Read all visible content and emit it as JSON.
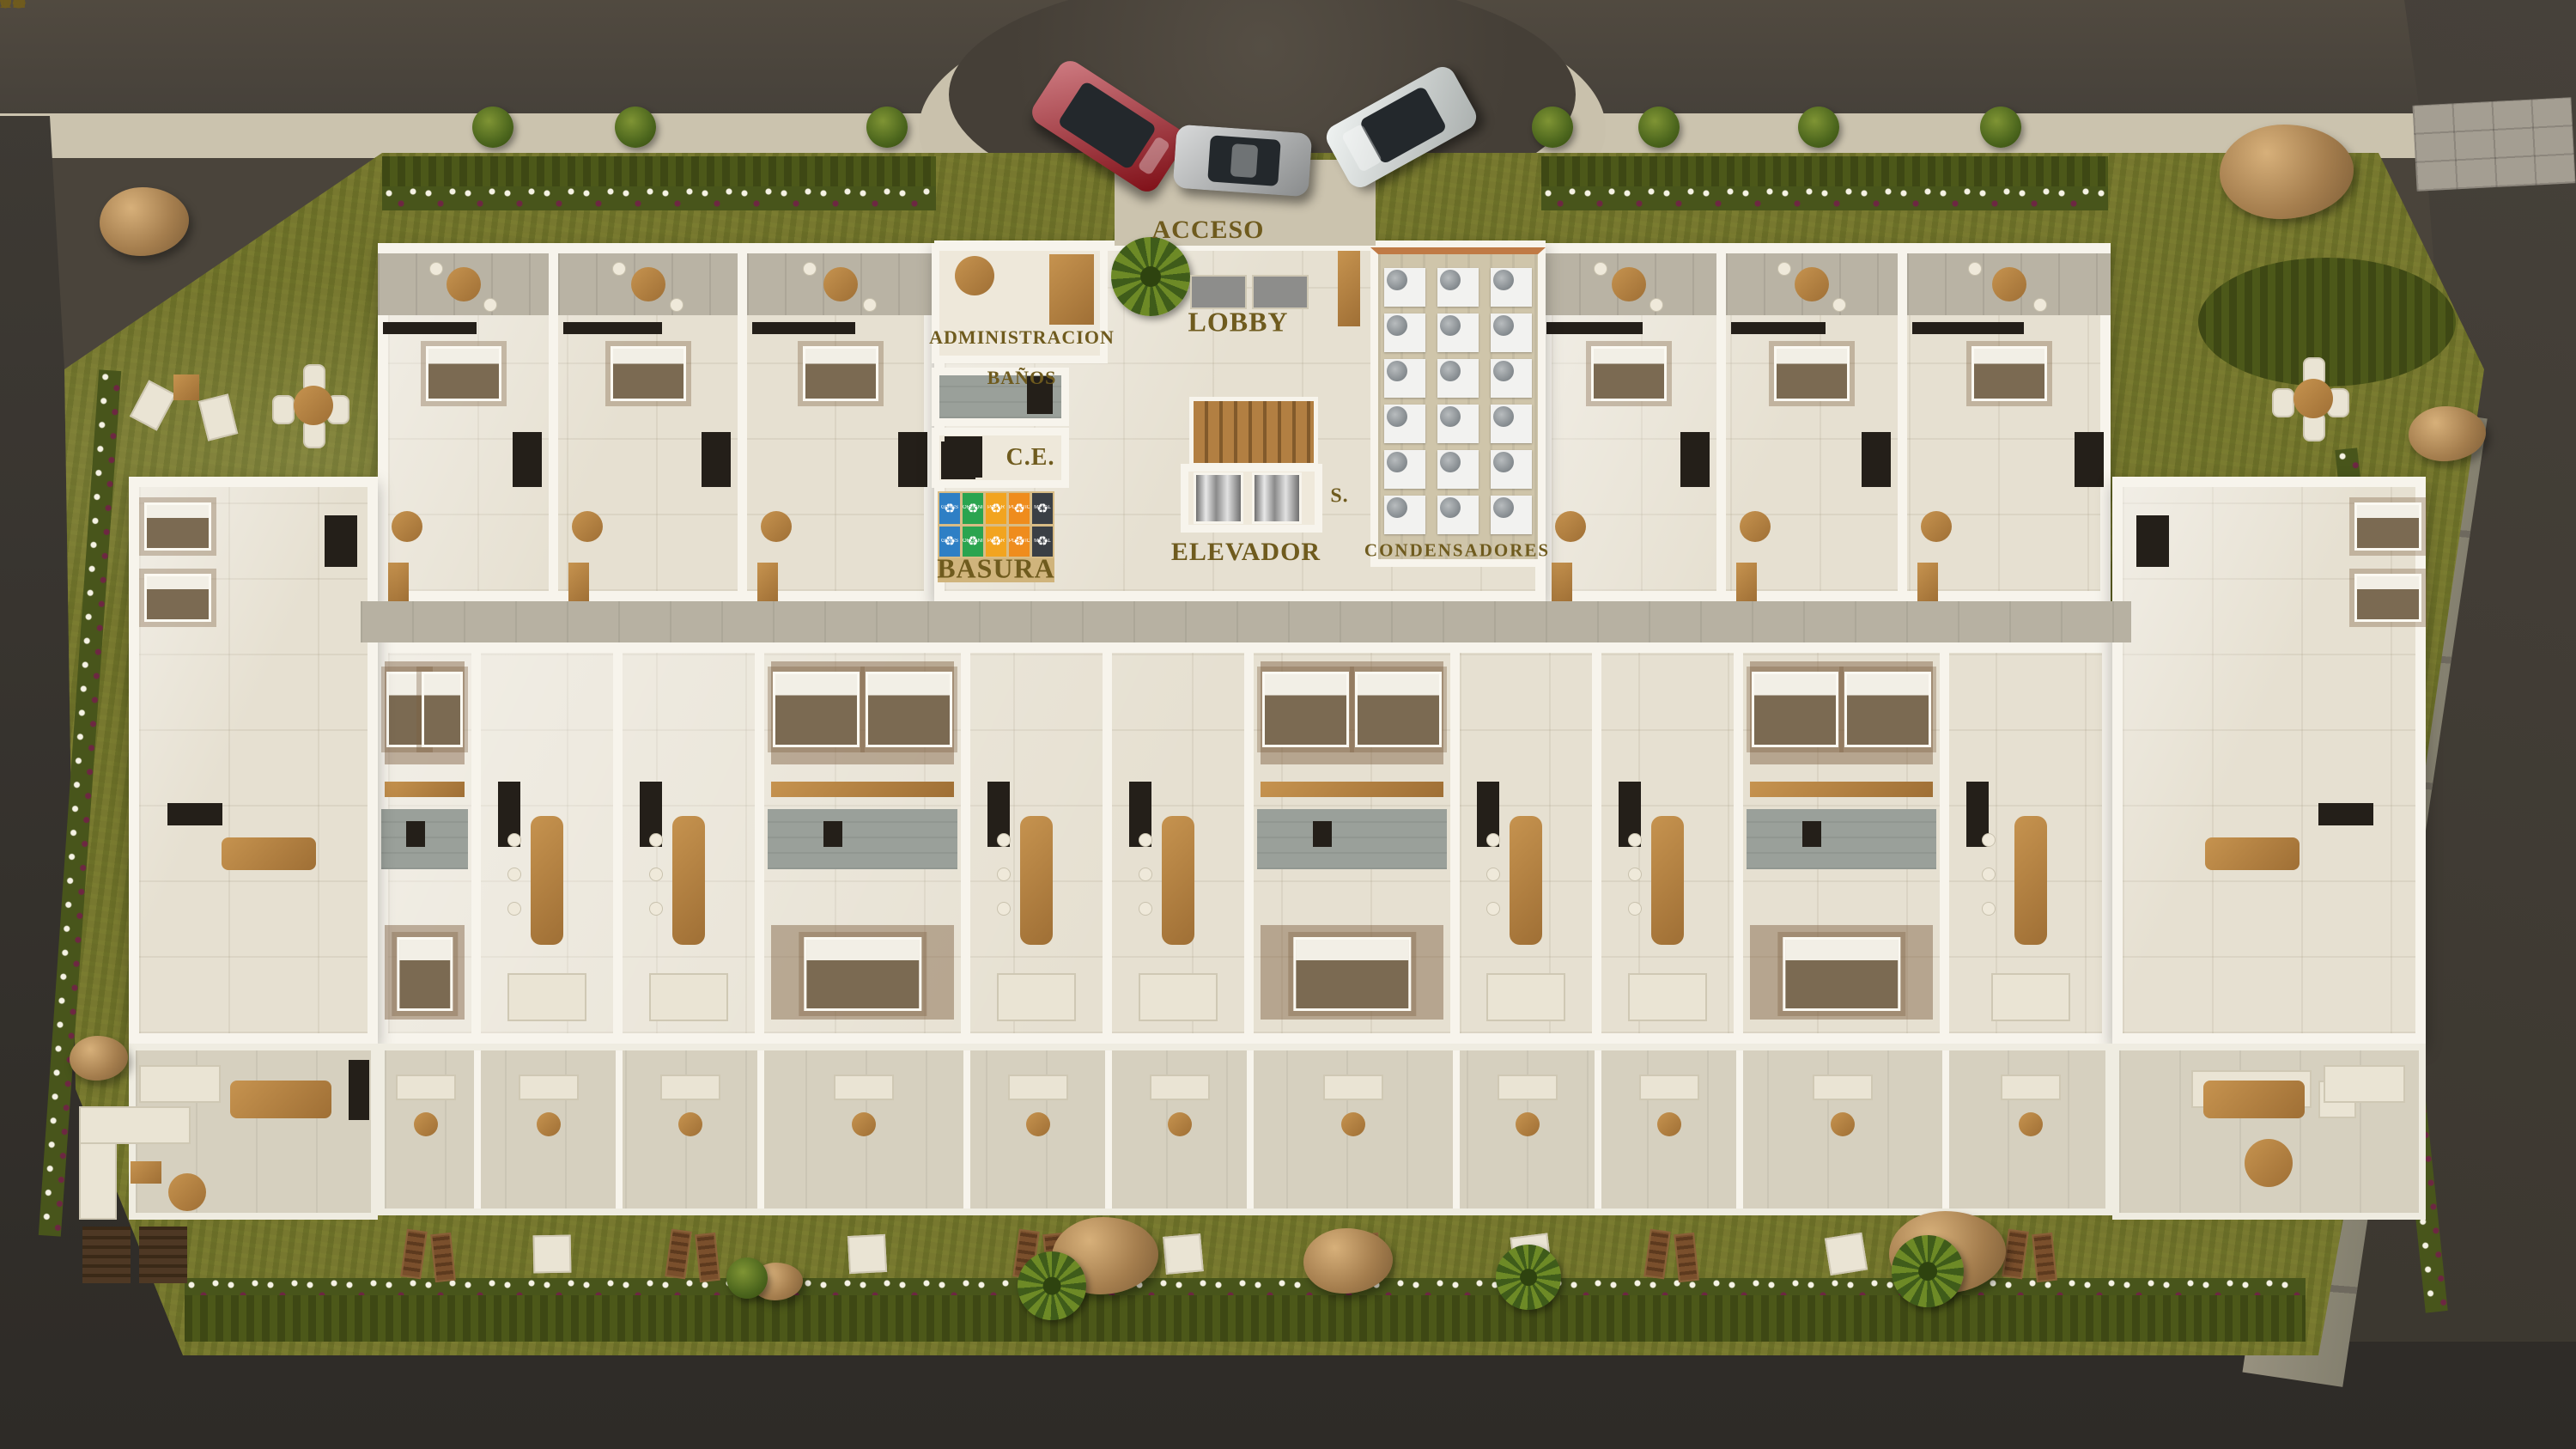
{
  "scene": {
    "description": "Ground-floor architectural site plan rendering with apartment units 1101-1115, lobby core and landscaped gardens"
  },
  "labels": {
    "acceso": "ACCESO",
    "administracion": "ADMINISTRACION",
    "banos": "BAÑOS",
    "lobby": "LOBBY",
    "ce": "C.E.",
    "basura": "BASURA",
    "elevador": "ELEVADOR",
    "stairs_abbrev": "S.",
    "condensadores": "CONDENSADORES"
  },
  "units": [
    {
      "number": "1101",
      "x_pct": 12.8,
      "y_pct": 41.8
    },
    {
      "number": "1102",
      "x_pct": 21.9,
      "y_pct": 49.9
    },
    {
      "number": "1103",
      "x_pct": 26.3,
      "y_pct": 49.9
    },
    {
      "number": "1104",
      "x_pct": 40.7,
      "y_pct": 49.9
    },
    {
      "number": "1105",
      "x_pct": 45.5,
      "y_pct": 49.9
    },
    {
      "number": "1106",
      "x_pct": 59.9,
      "y_pct": 49.9
    },
    {
      "number": "1107",
      "x_pct": 64.3,
      "y_pct": 49.9
    },
    {
      "number": "1108",
      "x_pct": 78.9,
      "y_pct": 49.9
    },
    {
      "number": "1109",
      "x_pct": 83.1,
      "y_pct": 41.8
    },
    {
      "number": "1110",
      "x_pct": 76.4,
      "y_pct": 35.2
    },
    {
      "number": "1111",
      "x_pct": 71.7,
      "y_pct": 35.2
    },
    {
      "number": "1112",
      "x_pct": 62.3,
      "y_pct": 35.2
    },
    {
      "number": "1113",
      "x_pct": 33.8,
      "y_pct": 35.2
    },
    {
      "number": "1114",
      "x_pct": 24.2,
      "y_pct": 35.2
    },
    {
      "number": "1115",
      "x_pct": 19.1,
      "y_pct": 35.2
    }
  ],
  "recycling": {
    "rows": 2,
    "symbol": "♻",
    "bins": [
      {
        "label": "GLASS",
        "color": "#2e7fc5"
      },
      {
        "label": "ORGANIC",
        "color": "#2aa44f"
      },
      {
        "label": "PAPER",
        "color": "#f2a41f"
      },
      {
        "label": "PLASTIC",
        "color": "#ef8c1d"
      },
      {
        "label": "METAL",
        "color": "#3a3f45"
      }
    ]
  },
  "condensers": {
    "rows": 6,
    "cols": 3
  },
  "cars": [
    {
      "name": "red-suv",
      "color": "#a8121d"
    },
    {
      "name": "silver-coupe",
      "color": "#b7babb"
    },
    {
      "name": "white-sedan",
      "color": "#e3eae8"
    }
  ],
  "colors": {
    "label_text": "#6f5b1e",
    "grass": "#77782f",
    "hedge": "#4c5819",
    "road": "#46413a",
    "sidewalk": "#cbc3ae",
    "floor": "#e6e0d1",
    "corridor": "#b7b1a2",
    "wall": "#f7f4ec",
    "wood": "#b5834a"
  }
}
